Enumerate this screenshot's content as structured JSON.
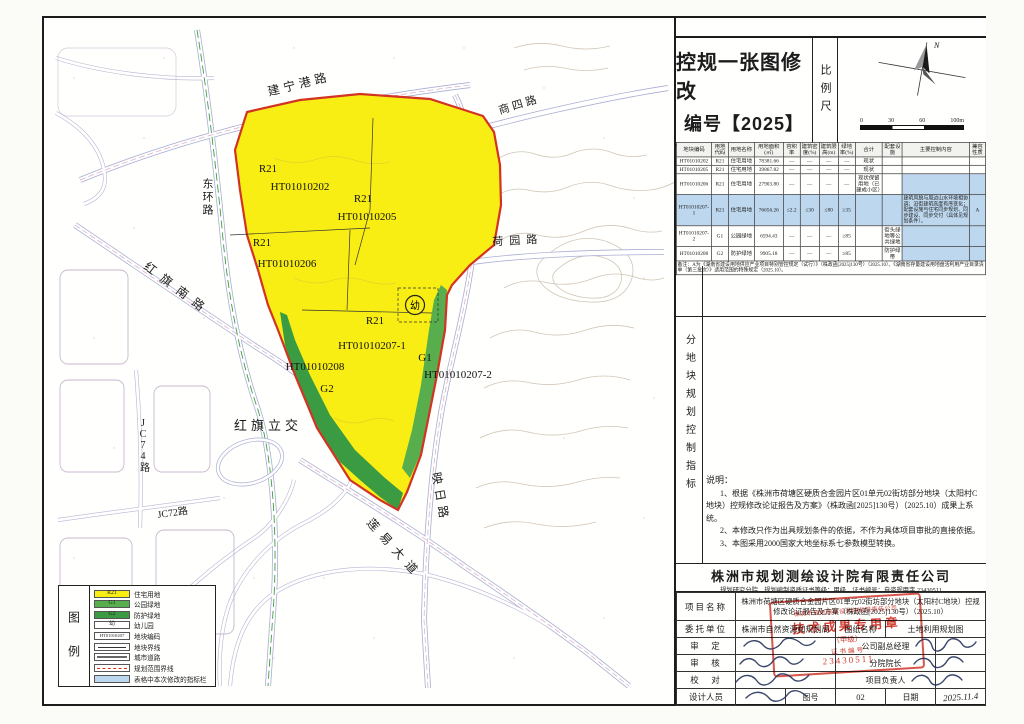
{
  "title_block": {
    "line1": "控规一张图修改",
    "line2": "编号【2025】",
    "scale_label": "比例尺",
    "north": "N",
    "scalebar": [
      "0",
      "30",
      "60",
      "100m"
    ]
  },
  "indicator_table": {
    "section_label": "分地块规划控制指标",
    "headers": [
      "地块编码",
      "用地代码",
      "用地名称",
      "用地面积(㎡)",
      "容积率",
      "建筑密度(%)",
      "建筑限高(m)",
      "绿地率(%)",
      "合计",
      "配套设施",
      "主要控制内容",
      "兼容性质"
    ],
    "rows": [
      {
        "cells": [
          "HT01010202",
          "R21",
          "住宅用地",
          "78381.66",
          "—",
          "—",
          "—",
          "—",
          "现状",
          "",
          "",
          ""
        ],
        "hl": []
      },
      {
        "cells": [
          "HT01010205",
          "R21",
          "住宅用地",
          "39867.82",
          "—",
          "—",
          "—",
          "—",
          "现状",
          "",
          "",
          ""
        ],
        "hl": []
      },
      {
        "cells": [
          "HT01010206",
          "R21",
          "住宅用地",
          "27903.80",
          "—",
          "—",
          "—",
          "—",
          "现状保留用地（已建成小区）",
          "",
          "",
          ""
        ],
        "hl": [
          10,
          11
        ]
      },
      {
        "cells": [
          "HT01010207-1",
          "R21",
          "住宅用地",
          "76656.26",
          "≤2.2",
          "≤30",
          "≤80",
          "≥35",
          "",
          "",
          "建筑风貌与周边山水环境相协调；沿街建筑高度有序变化；配套设施与住宅同步规划、同步建设、同步交付（具体见规划条件）。",
          "A"
        ],
        "hl": "all"
      },
      {
        "cells": [
          "HT01010207-2",
          "G1",
          "公园绿地",
          "6594.43",
          "—",
          "—",
          "—",
          "≥85",
          "",
          "街头绿地等公共绿地",
          "",
          ""
        ],
        "hl": [
          10,
          11
        ]
      },
      {
        "cells": [
          "HT01010208",
          "G2",
          "防护绿地",
          "9905.18",
          "—",
          "—",
          "—",
          "≥85",
          "",
          "防护绿带",
          "",
          ""
        ],
        "hl": [
          10,
          11
        ]
      }
    ],
    "footnote": "备注：A为《湖南省建设用地供应产业项目特别管控规定（试行）》（株政函[2025]130号）（2025.10）、《湖南省存量建设用地盘活利用产业目录清单（第三批次）》适用范围的特殊规定（2025.10）。"
  },
  "notes": {
    "heading": "说明：",
    "items": [
      "1、根据《株洲市荷塘区硬质合金园片区01单元02街坊部分地块（太阳村C地块）控规修改论证报告及方案》（株政函[2025]130号）（2025.10）成果上系统。",
      "2、本修改只作为出具规划条件的依据，不作为具体项目审批的直接依据。",
      "3、本图采用2000国家大地坐标系七参数模型转换。"
    ]
  },
  "company": {
    "name": "株洲市规划测绘设计院有限责任公司",
    "credential": "规划研究分院　规划编制资质证书等级：甲级　证书编号：自资规甲字 23430511"
  },
  "info_table": {
    "project_label": "项目名称",
    "project_value": "株洲市荷塘区硬质合金园片区01单元02街坊部分地块（太阳村C地块）控规修改论证报告及方案（株政函[2025]130号）（2025.10）",
    "client_label": "委托单位",
    "client_value": "株洲市自然资源和规划局",
    "sheet_label": "图纸名称",
    "sheet_value": "土地利用规划图",
    "approve_label": "审　定",
    "approve_role": "公司副总经理",
    "review_label": "审　核",
    "review_role": "分院院长",
    "proof_label": "校　对",
    "proof_role": "项目负责人",
    "design_label": "设计人员",
    "figno_label": "图号",
    "figno_value": "02",
    "date_label": "日期",
    "date_value": "2025.11.4"
  },
  "stamp": {
    "lines": [
      "株洲市规划测绘设计院有限责任公司",
      "技术成果专用章",
      "（甲级）",
      "证书编号",
      "23430511"
    ]
  },
  "legend": {
    "label": "图例",
    "items": [
      {
        "kind": "r21",
        "swatch_text": "R21",
        "label": "住宅用地"
      },
      {
        "kind": "g1",
        "swatch_text": "G1",
        "label": "公园绿地"
      },
      {
        "kind": "g2",
        "swatch_text": "G2",
        "label": "防护绿地"
      },
      {
        "kind": "kinder",
        "swatch_text": "幼",
        "label": "幼儿园"
      },
      {
        "kind": "code",
        "swatch_text": "HT01010207",
        "label": "地块编码"
      },
      {
        "kind": "plot-line",
        "swatch_text": "",
        "label": "地块界线"
      },
      {
        "kind": "road",
        "swatch_text": "",
        "label": "城市道路"
      },
      {
        "kind": "plan-line",
        "swatch_text": "",
        "label": "规划范围界线"
      },
      {
        "kind": "modified",
        "swatch_text": "",
        "label": "表格中本次修改的指标栏"
      }
    ]
  },
  "map": {
    "road_labels": {
      "jianning": "建宁港路",
      "shangsi": "商四路",
      "donghuan": "东环路",
      "hongqinan": "红旗南路",
      "heyuan": "荷园路",
      "hongqilijiao": "红旗立交",
      "jc74": "JC74路",
      "jc72": "JC72路",
      "yingri": "映日路",
      "lianyi": "莲易大道"
    },
    "plots": {
      "r21": "R21",
      "p202": "HT01010202",
      "p205": "HT01010205",
      "p206": "HT01010206",
      "p2071": "HT01010207-1",
      "p2072": "HT01010207-2",
      "p208": "HT01010208",
      "g1": "G1",
      "g2": "G2",
      "kinder": "幼"
    }
  },
  "colors": {
    "residential": "#f8ee14",
    "park_green": "#58ad4c",
    "protect_green": "#3b9b43",
    "boundary_red": "#d23323",
    "modified_blue": "#bdd7ee",
    "stamp_red": "#cd2a1e",
    "road_casing": "#a9aed2"
  }
}
